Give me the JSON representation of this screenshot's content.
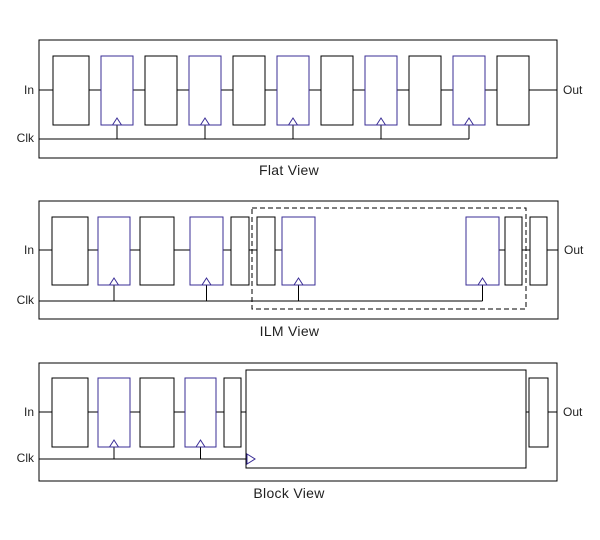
{
  "diagram": {
    "background_color": "#ffffff",
    "line_color": "#000000",
    "flipflop_color": "#3a2d96",
    "text_color": "#1f1f1f",
    "views": [
      {
        "id": "flat",
        "caption": "Flat View",
        "labels": {
          "in": "In",
          "clk": "Clk",
          "out": "Out"
        },
        "geometry": {
          "box": {
            "x": 39,
            "y": 40,
            "w": 518,
            "h": 118
          },
          "mid_y": 90,
          "clk_y": 139,
          "block_top": 56,
          "block_h": 69
        },
        "blocks": [
          {
            "type": "buf",
            "x": 53,
            "w": 36
          },
          {
            "type": "ff",
            "x": 101,
            "w": 32
          },
          {
            "type": "buf",
            "x": 145,
            "w": 32
          },
          {
            "type": "ff",
            "x": 189,
            "w": 32
          },
          {
            "type": "buf",
            "x": 233,
            "w": 32
          },
          {
            "type": "ff",
            "x": 277,
            "w": 32
          },
          {
            "type": "buf",
            "x": 321,
            "w": 32
          },
          {
            "type": "ff",
            "x": 365,
            "w": 32
          },
          {
            "type": "buf",
            "x": 409,
            "w": 32
          },
          {
            "type": "ff",
            "x": 453,
            "w": 32
          },
          {
            "type": "buf",
            "x": 497,
            "w": 32
          }
        ],
        "no_connector_after": []
      },
      {
        "id": "ilm",
        "caption": "ILM View",
        "labels": {
          "in": "In",
          "clk": "Clk",
          "out": "Out"
        },
        "geometry": {
          "box": {
            "x": 39,
            "y": 201,
            "w": 519,
            "h": 118
          },
          "mid_y": 250,
          "clk_y": 301,
          "block_top": 217,
          "block_h": 68
        },
        "dashed_box": {
          "x": 252,
          "y": 208,
          "w": 274,
          "h": 101
        },
        "blocks": [
          {
            "type": "buf",
            "x": 52,
            "w": 36
          },
          {
            "type": "ff",
            "x": 98,
            "w": 32
          },
          {
            "type": "buf",
            "x": 140,
            "w": 34
          },
          {
            "type": "ff",
            "x": 190,
            "w": 33
          },
          {
            "type": "pin",
            "x": 231,
            "w": 18
          },
          {
            "type": "pin",
            "x": 257,
            "w": 18
          },
          {
            "type": "ff",
            "x": 282,
            "w": 33
          },
          {
            "type": "ff",
            "x": 466,
            "w": 33
          },
          {
            "type": "pin",
            "x": 505,
            "w": 17
          },
          {
            "type": "pin",
            "x": 530,
            "w": 17
          }
        ],
        "no_connector_after": [
          6
        ]
      },
      {
        "id": "block",
        "caption": "Block View",
        "labels": {
          "in": "In",
          "clk": "Clk",
          "out": "Out"
        },
        "geometry": {
          "box": {
            "x": 39,
            "y": 363,
            "w": 518,
            "h": 118
          },
          "mid_y": 412,
          "clk_y": 459,
          "block_top": 378,
          "block_h": 69
        },
        "blocks": [
          {
            "type": "buf",
            "x": 52,
            "w": 36
          },
          {
            "type": "ff",
            "x": 98,
            "w": 32
          },
          {
            "type": "buf",
            "x": 140,
            "w": 34
          },
          {
            "type": "ff",
            "x": 185,
            "w": 31
          },
          {
            "type": "pin",
            "x": 224,
            "w": 17
          },
          {
            "type": "macro",
            "x": 246,
            "w": 280,
            "top": 370,
            "h": 98
          },
          {
            "type": "pin",
            "x": 529,
            "w": 19
          }
        ],
        "no_connector_after": []
      }
    ]
  }
}
